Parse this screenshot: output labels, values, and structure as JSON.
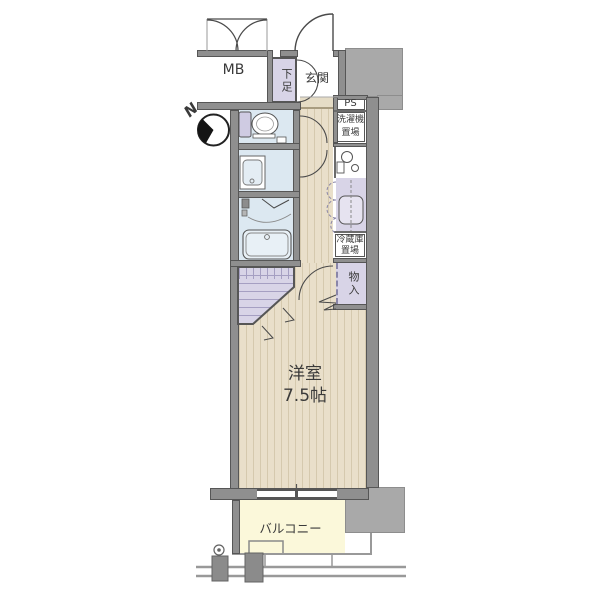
{
  "floorplan": {
    "type": "apartment-floor-plan",
    "compass": {
      "north": "N"
    },
    "rooms": {
      "meter_box": "MB",
      "shoe_cabinet": "下足",
      "entrance": "玄関",
      "pipe_space": "PS",
      "washer_space_line1": "洗濯機",
      "washer_space_line2": "置場",
      "fridge_space_line1": "冷蔵庫",
      "fridge_space_line2": "置場",
      "storage": "物入",
      "western_room_name": "洋室",
      "western_room_size": "7.5帖",
      "balcony": "バルコニー"
    },
    "colors": {
      "outside_gray": "#a9a9a9",
      "wall_gray": "#8f8f8f",
      "wall_edge": "#565656",
      "floor_beige": "#e9dfca",
      "floor_stripe": "#d5c9ae",
      "entrance_tile": "#e5dcc6",
      "wet_area_blue": "#dce8f1",
      "storage_lavender": "#d8d4e7",
      "balcony_yellow": "#fbf8da",
      "text": "#3a3a3a"
    }
  }
}
